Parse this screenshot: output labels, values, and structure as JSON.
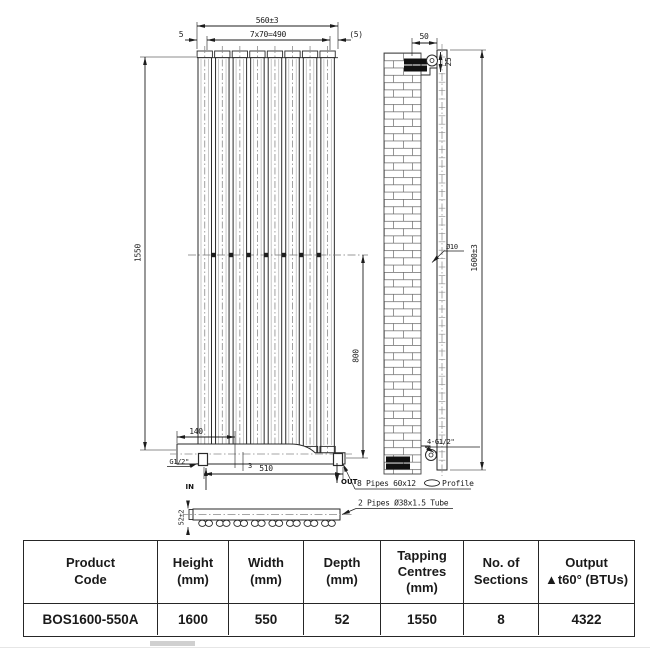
{
  "drawing": {
    "front": {
      "dim_overall_width": "560±3",
      "dim_sections": "7x70=490",
      "dim_left_offset": "5",
      "dim_right_offset": "(5)",
      "dim_tapping_height": "1550",
      "dim_lower_height": "800",
      "dim_valve_offset": "140",
      "dim_gap": "3",
      "dim_bottom_centres": "510",
      "label_thread": "G1/2\"",
      "label_in": "IN",
      "label_out": "OUT"
    },
    "side": {
      "dim_bracket": "50",
      "dim_top_offset": "25",
      "dim_hole": "Ø10",
      "dim_overall_height": "1600±3",
      "label_connections": "4-G1/2\""
    },
    "plan": {
      "dim_depth": "52±2",
      "note_profile_prefix": "8 Pipes 60x12",
      "note_profile_suffix": "Profile",
      "note_tube": "2 Pipes Ø38x1.5 Tube"
    }
  },
  "table": {
    "headers": [
      {
        "lines": [
          "Product",
          "Code"
        ]
      },
      {
        "lines": [
          "Height",
          "(mm)"
        ]
      },
      {
        "lines": [
          "Width",
          "(mm)"
        ]
      },
      {
        "lines": [
          "Depth",
          "(mm)"
        ]
      },
      {
        "lines": [
          "Tapping",
          "Centres",
          "(mm)"
        ]
      },
      {
        "lines": [
          "No. of",
          "Sections"
        ]
      },
      {
        "lines": [
          "Output",
          "▲t60° (BTUs)"
        ]
      }
    ],
    "row": [
      "BOS1600-550A",
      "1600",
      "550",
      "52",
      "1550",
      "8",
      "4322"
    ]
  }
}
